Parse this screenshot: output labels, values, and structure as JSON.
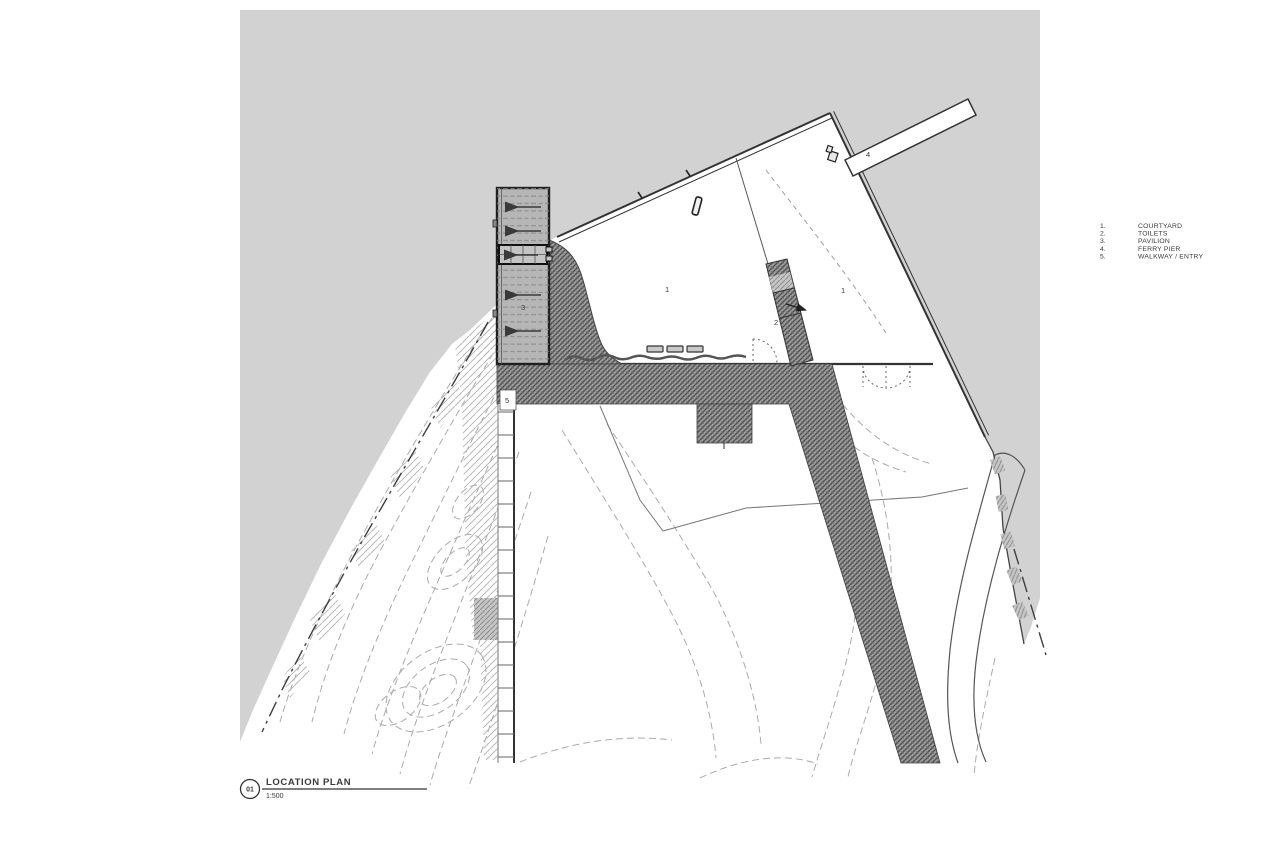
{
  "drawing": {
    "title_block": {
      "number": "01",
      "title": "LOCATION PLAN",
      "scale": "1:500"
    },
    "legend": {
      "items": [
        {
          "num": "1.",
          "label": "COURTYARD"
        },
        {
          "num": "2.",
          "label": "TOILETS"
        },
        {
          "num": "3.",
          "label": "PAVILION"
        },
        {
          "num": "4.",
          "label": "FERRY PIER"
        },
        {
          "num": "5.",
          "label": "WALKWAY / ENTRY"
        }
      ]
    },
    "plan_labels": {
      "courtyard_left": "1",
      "courtyard_right": "1",
      "toilets": "2",
      "pavilion": "3",
      "ferry_pier": "4",
      "walkway": "5"
    },
    "colors": {
      "sea": "#d2d2d2",
      "pavilion_fill": "#b6b6b6",
      "hatch_dark": "#9d9d9d",
      "line_dark": "#333333",
      "contour": "#ababab"
    }
  }
}
